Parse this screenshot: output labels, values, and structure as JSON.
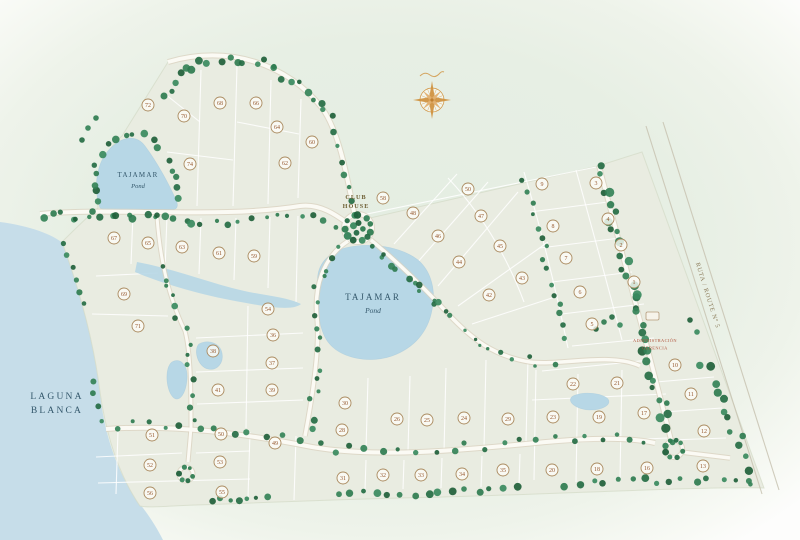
{
  "labels": {
    "lagoon": [
      "LAGUNA",
      "BLANCA"
    ],
    "pond_left": [
      "TAJAMAR",
      "Pond"
    ],
    "pond_center": [
      "TAJAMAR",
      "Pond"
    ],
    "club_house": [
      "CLUB",
      "HOUSE"
    ],
    "admin": [
      "ADMINISTRACIÓN",
      "GERENCIA"
    ],
    "route": "RUTA / ROUTE Nº 5"
  },
  "colors": {
    "water": "#c6dde9",
    "pond": "#b7d7e6",
    "pond_edge": "#9fc6da",
    "property": "#e9ece1",
    "property_edge": "#d3dac6",
    "road": "#fbfaf4",
    "road_casing": "#d9d1bf",
    "highway_line": "#c8c3b2",
    "lot_line": "#ffffff",
    "lot_ring": "#aa8a5f",
    "lot_fill": "#fdfcf7",
    "lot_num": "#96582f",
    "compass": "#d0923f",
    "tree_palette": [
      "#2f7c50",
      "#256c44",
      "#3a8a5e",
      "#1f5f3a",
      "#348257"
    ]
  },
  "map": {
    "lagoon": "M0,222 C30,226 52,234 64,244 C84,302 95,352 100,394 C105,438 119,478 143,508 C152,520 158,530 163,540 L0,540 Z",
    "property": "M168,62 C228,44 288,64 322,108 C338,130 346,170 354,212 L370,218 L598,166 L642,152 L764,488 C700,486 520,496 400,498 C320,500 230,504 196,505 C168,506 148,508 140,506 C118,474 106,434 100,392 C95,352 84,302 62,242 C74,230 86,218 98,208 C96,178 104,150 122,136 Z",
    "wetland": "M137,262 C170,268 202,280 232,288 C262,296 284,296 301,304 C292,312 262,306 230,300 C198,294 158,282 135,272 Z",
    "ponds": [
      "M100,208 C92,184 98,158 113,146 C124,136 137,135 145,146 C157,162 169,184 176,200 C179,206 177,210 171,210 L107,211 Z",
      "M318,285 C315,265 329,252 345,248 C370,242 400,246 418,260 C432,272 436,292 432,310 C428,332 414,348 392,356 C368,364 340,358 328,342 C319,330 316,305 318,285 Z",
      "M199,344 C208,339 220,343 222,353 C224,363 217,371 208,369 C198,367 193,350 199,344 Z",
      "M172,362 C180,357 188,365 187,379 C186,393 180,402 174,398 C166,392 164,368 172,362 Z",
      "M573,396 C584,391 602,393 608,399 C612,405 602,410 590,410 C577,410 565,401 573,396 Z"
    ],
    "lot_lines": [
      "M201,70 L197,206",
      "M237,66 L233,206",
      "M271,80 L268,204",
      "M301,99 L298,198",
      "M165,94 L200,122",
      "M237,122 L299,134",
      "M167,152 L233,160",
      "M362,215 L596,167",
      "M394,244 L457,174",
      "M416,264 L488,182",
      "M438,286 L518,192",
      "M458,306 L548,242",
      "M472,324 L558,296",
      "M448,178 C480,212 506,254 524,302",
      "M524,172 C542,232 556,290 568,348",
      "M576,170 C592,228 608,286 622,340",
      "M530,212 L608,202",
      "M540,248 L620,238",
      "M552,282 L632,272",
      "M562,314 L644,304",
      "M572,346 L654,338",
      "M368,378 L366,450",
      "M410,376 L408,452",
      "M446,368 L444,452",
      "M486,360 L484,448",
      "M528,358 L526,442",
      "M366,460 L365,490",
      "M404,460 L403,489",
      "M442,458 L441,488",
      "M482,456 L481,487",
      "M520,454 L519,485",
      "M248,306 L246,428",
      "M196,338 L303,333",
      "M196,372 L303,368",
      "M197,404 L303,400",
      "M133,214 L131,264",
      "M167,216 L165,270",
      "M201,218 L199,274",
      "M236,218 L234,280",
      "M270,217 L268,288",
      "M298,216 L296,302",
      "M96,276 L158,273",
      "M92,314 L168,316",
      "M118,430 L116,494",
      "M250,432 L248,498",
      "M296,436 L294,500",
      "M96,457 L182,453",
      "M196,453 L250,451",
      "M98,483 L250,479",
      "M536,370 L534,480",
      "M578,374 L576,482",
      "M622,370 L620,478",
      "M532,400 L666,394",
      "M534,444 L668,438",
      "M542,371 L650,360",
      "M656,382 L714,377",
      "M664,412 L722,408",
      "M670,440 L726,438"
    ],
    "roads": [
      {
        "d": "M168,62 C228,44 288,64 322,108 C338,130 346,170 354,212",
        "w": 4
      },
      {
        "d": "M40,214 C120,207 220,219 300,206 C322,203 340,218 350,225",
        "w": 4
      },
      {
        "d": "M348,241 C322,258 314,288 317,318 C320,344 313,394 305,436",
        "w": 3.5
      },
      {
        "d": "M371,240 C399,263 429,293 453,319 C471,337 492,356 530,362 C560,366 612,352 640,366",
        "w": 3.5
      },
      {
        "d": "M599,166 C613,220 627,272 641,324 C653,368 664,412 671,440",
        "w": 3.8
      },
      {
        "d": "M106,429 C176,424 246,434 312,447 C382,459 472,449 546,442 C590,438 626,437 655,443",
        "w": 4
      },
      {
        "d": "M157,217 C159,244 164,288 185,331 C191,354 191,392 191,428",
        "w": 3
      },
      {
        "d": "M191,428 L188,462",
        "w": 3
      },
      {
        "d": "M681,452 L730,458",
        "w": 3.5
      }
    ],
    "road_circles": [
      {
        "cx": 358,
        "cy": 228,
        "r": 14,
        "w": 4
      },
      {
        "cx": 674,
        "cy": 449,
        "r": 8.5,
        "w": 3.2
      },
      {
        "cx": 186,
        "cy": 474,
        "r": 7,
        "w": 3
      }
    ],
    "highway_lines": [
      "M646,126 L762,494",
      "M663,122 L779,490"
    ],
    "tree_paths": [
      {
        "d": "M160,98 C185,58 235,50 272,68 C300,80 318,98 330,120",
        "n": 24,
        "j": 5,
        "r": [
          2.2,
          4.2
        ]
      },
      {
        "d": "M333,128 C341,156 349,184 354,206",
        "n": 6,
        "j": 3,
        "r": [
          2,
          3.5
        ]
      },
      {
        "d": "M100,206 C86,172 96,148 122,138 C140,130 154,138 163,150",
        "n": 13,
        "j": 3.5,
        "r": [
          2.2,
          4
        ]
      },
      {
        "d": "M166,154 C172,170 177,188 179,204",
        "n": 5,
        "j": 2.5,
        "r": [
          2,
          3.5
        ]
      },
      {
        "d": "M42,218 C92,212 150,215 205,221",
        "n": 20,
        "j": 4.5,
        "r": [
          2,
          4
        ]
      },
      {
        "d": "M212,222 C252,224 300,207 338,227",
        "n": 11,
        "j": 4,
        "r": [
          1.8,
          3.4
        ]
      },
      {
        "d": "M374,246 C402,270 430,298 454,322",
        "n": 14,
        "j": 6,
        "r": [
          1.8,
          3.6
        ]
      },
      {
        "d": "M347,244 C323,262 315,290 318,320 C321,346 314,392 307,434",
        "n": 16,
        "j": 5,
        "r": [
          1.8,
          3.6
        ]
      },
      {
        "d": "M159,258 C164,286 173,312 185,332 C191,354 191,392 191,424",
        "n": 14,
        "j": 5,
        "r": [
          1.8,
          3.4
        ]
      },
      {
        "d": "M107,425 C175,420 245,432 312,445 C380,457 472,447 544,441",
        "n": 26,
        "j": 5,
        "r": [
          1.8,
          3.6
        ]
      },
      {
        "d": "M550,440 C592,436 626,436 652,442",
        "n": 7,
        "j": 4,
        "r": [
          1.8,
          3.2
        ]
      },
      {
        "d": "M599,167 C613,220 627,272 641,324 C653,368 663,410 671,441",
        "n": 34,
        "j": 6,
        "r": [
          2.6,
          4.6
        ]
      },
      {
        "d": "M700,356 C722,398 740,442 755,483",
        "n": 13,
        "j": 5,
        "r": [
          2.6,
          4.4
        ]
      },
      {
        "d": "M208,500 L272,497",
        "n": 7,
        "j": 2.5,
        "r": [
          2,
          3.6
        ]
      },
      {
        "d": "M332,492 C392,497 452,491 522,488",
        "n": 15,
        "j": 3,
        "r": [
          2,
          4
        ]
      },
      {
        "d": "M560,485 C622,481 688,478 754,482",
        "n": 15,
        "j": 3,
        "r": [
          2.2,
          4.2
        ]
      },
      {
        "d": "M63,240 C72,264 78,290 84,312",
        "n": 6,
        "j": 3,
        "r": [
          2,
          3.6
        ]
      },
      {
        "d": "M456,324 C482,346 520,360 558,364",
        "n": 9,
        "j": 5,
        "r": [
          1.6,
          3
        ]
      },
      {
        "d": "M524,176 C540,234 554,290 566,344",
        "n": 15,
        "j": 4,
        "r": [
          1.8,
          3.4
        ]
      },
      {
        "d": "M92,374 C96,398 100,414 104,426",
        "n": 4,
        "j": 3,
        "r": [
          1.8,
          3.2
        ]
      }
    ],
    "tree_rings": [
      {
        "cx": 358,
        "cy": 228,
        "r": 13,
        "n": 11,
        "tr": [
          2.4,
          4
        ]
      },
      {
        "cx": 358,
        "cy": 228,
        "r": 5,
        "n": 4,
        "tr": [
          2.4,
          3.6
        ]
      },
      {
        "cx": 674,
        "cy": 449,
        "r": 9,
        "n": 8,
        "tr": [
          2.2,
          3.6
        ]
      },
      {
        "cx": 186,
        "cy": 474,
        "r": 7,
        "n": 6,
        "tr": [
          1.8,
          3
        ]
      }
    ],
    "tree_points": [
      [
        604,
        322
      ],
      [
        612,
        317
      ],
      [
        620,
        325
      ],
      [
        596,
        329
      ],
      [
        88,
        128
      ],
      [
        96,
        118
      ],
      [
        82,
        140
      ],
      [
        697,
        332
      ],
      [
        690,
        320
      ]
    ],
    "lots": [
      [
        148,
        105,
        72
      ],
      [
        184,
        116,
        70
      ],
      [
        220,
        103,
        68
      ],
      [
        256,
        103,
        66
      ],
      [
        277,
        127,
        64
      ],
      [
        285,
        163,
        62
      ],
      [
        190,
        164,
        74
      ],
      [
        312,
        142,
        60
      ],
      [
        114,
        238,
        67
      ],
      [
        148,
        243,
        65
      ],
      [
        182,
        247,
        63
      ],
      [
        219,
        253,
        61
      ],
      [
        254,
        256,
        59
      ],
      [
        124,
        294,
        69
      ],
      [
        138,
        326,
        71
      ],
      [
        268,
        309,
        54
      ],
      [
        213,
        351,
        38
      ],
      [
        273,
        335,
        36
      ],
      [
        272,
        363,
        37
      ],
      [
        218,
        390,
        41
      ],
      [
        272,
        390,
        39
      ],
      [
        383,
        198,
        58
      ],
      [
        413,
        213,
        48
      ],
      [
        438,
        236,
        46
      ],
      [
        459,
        262,
        44
      ],
      [
        489,
        295,
        42
      ],
      [
        468,
        189,
        50
      ],
      [
        481,
        216,
        47
      ],
      [
        500,
        246,
        45
      ],
      [
        522,
        278,
        43
      ],
      [
        542,
        184,
        9
      ],
      [
        596,
        183,
        3
      ],
      [
        553,
        226,
        8
      ],
      [
        608,
        219,
        4
      ],
      [
        566,
        258,
        7
      ],
      [
        621,
        245,
        2
      ],
      [
        580,
        292,
        6
      ],
      [
        634,
        282,
        1
      ],
      [
        592,
        324,
        5
      ],
      [
        675,
        365,
        10
      ],
      [
        691,
        394,
        11
      ],
      [
        704,
        431,
        12
      ],
      [
        703,
        466,
        13
      ],
      [
        573,
        384,
        22
      ],
      [
        617,
        383,
        21
      ],
      [
        553,
        417,
        23
      ],
      [
        599,
        417,
        19
      ],
      [
        644,
        413,
        17
      ],
      [
        552,
        470,
        20
      ],
      [
        597,
        469,
        18
      ],
      [
        647,
        468,
        16
      ],
      [
        345,
        403,
        30
      ],
      [
        342,
        430,
        28
      ],
      [
        397,
        419,
        26
      ],
      [
        427,
        420,
        25
      ],
      [
        464,
        418,
        24
      ],
      [
        508,
        419,
        29
      ],
      [
        343,
        478,
        31
      ],
      [
        383,
        475,
        32
      ],
      [
        421,
        475,
        33
      ],
      [
        462,
        474,
        34
      ],
      [
        503,
        470,
        35
      ],
      [
        152,
        435,
        51
      ],
      [
        221,
        434,
        50
      ],
      [
        275,
        443,
        49
      ],
      [
        150,
        465,
        52
      ],
      [
        220,
        462,
        53
      ],
      [
        150,
        493,
        56
      ],
      [
        222,
        492,
        55
      ]
    ]
  }
}
